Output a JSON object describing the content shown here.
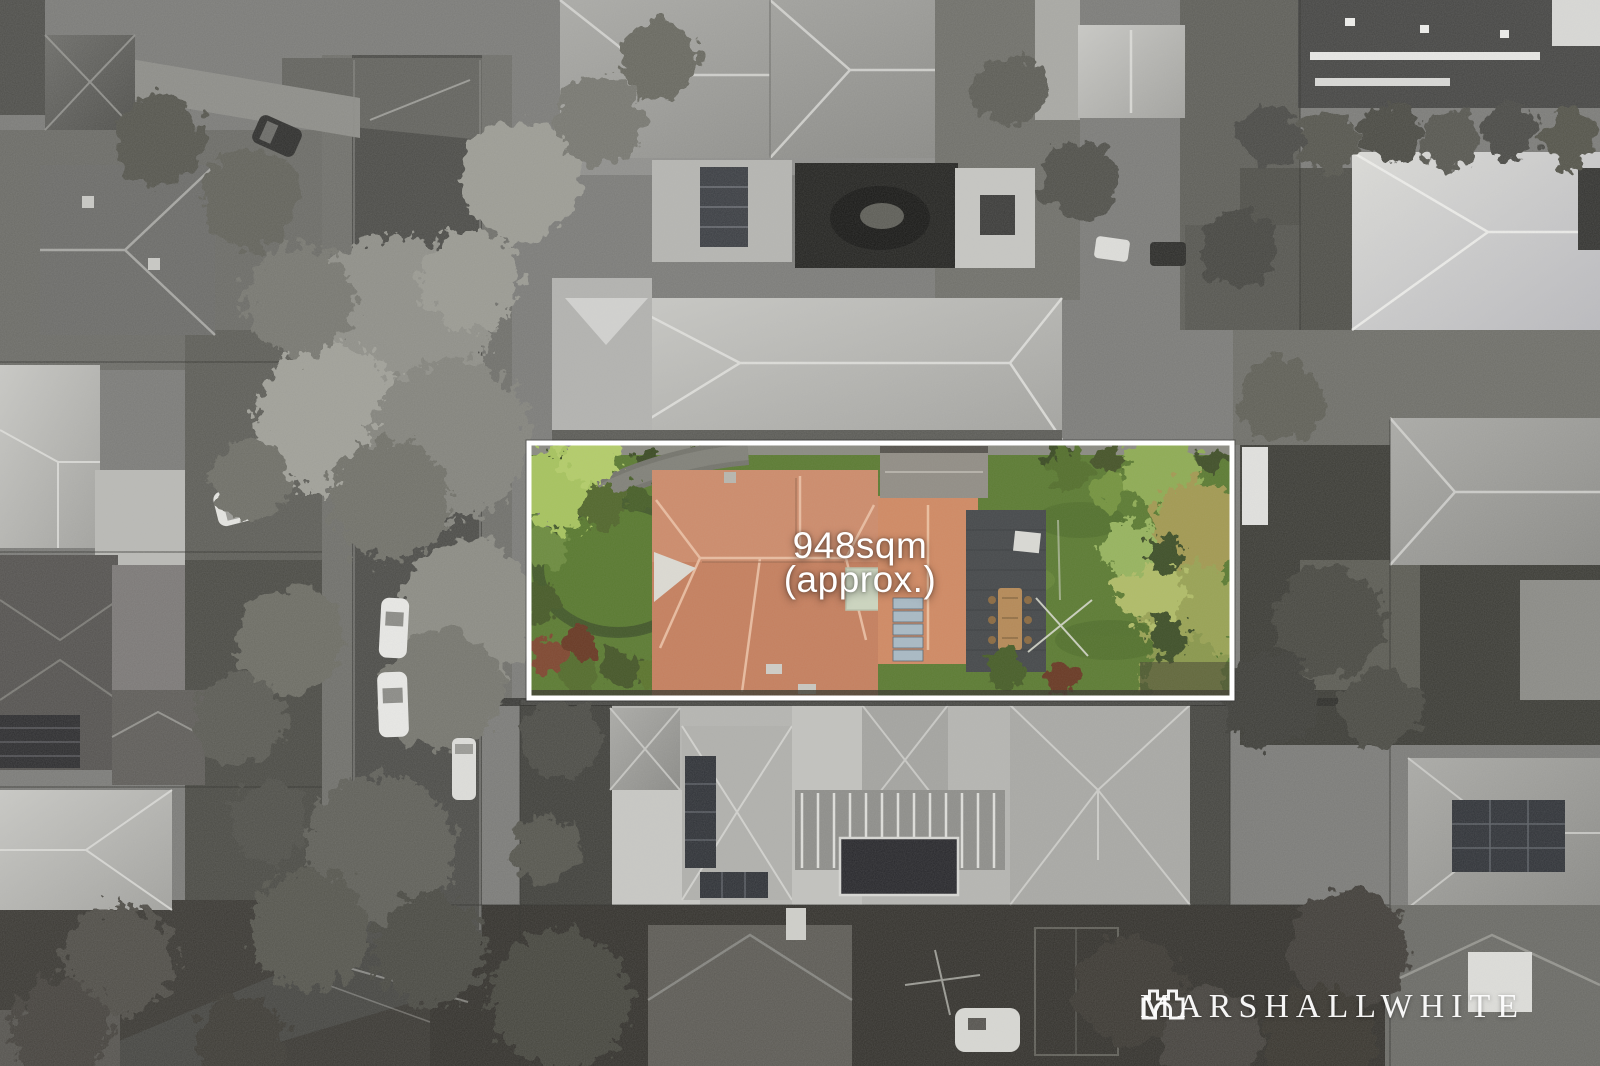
{
  "photo": {
    "type": "aerial drone photograph of suburban properties",
    "style": "grayscale photo with colour-highlighted property lot"
  },
  "overlay": {
    "area_line1": "948sqm",
    "area_line2": "(approx.)",
    "text_color": "#ffffff"
  },
  "watermark": {
    "brand": "MARSHALLWHITE",
    "icon": "castle-icon",
    "color": "#ffffff"
  },
  "highlight": {
    "border_color": "#ffffff",
    "grass_color": "#5d7c34",
    "roof_color": "#c5805f",
    "rear_roof_color": "#d08a64",
    "sage_roof_color": "#ccd5bf",
    "deck_color": "#474a4c",
    "solar_panel_color": "#a9bac4",
    "tree_olive": "#a39a52",
    "tree_green": "#8fac55"
  },
  "scene": {
    "base_color": "#7b7b78",
    "road_color": "#4b4b47",
    "car_color": "#e9e9e6"
  }
}
